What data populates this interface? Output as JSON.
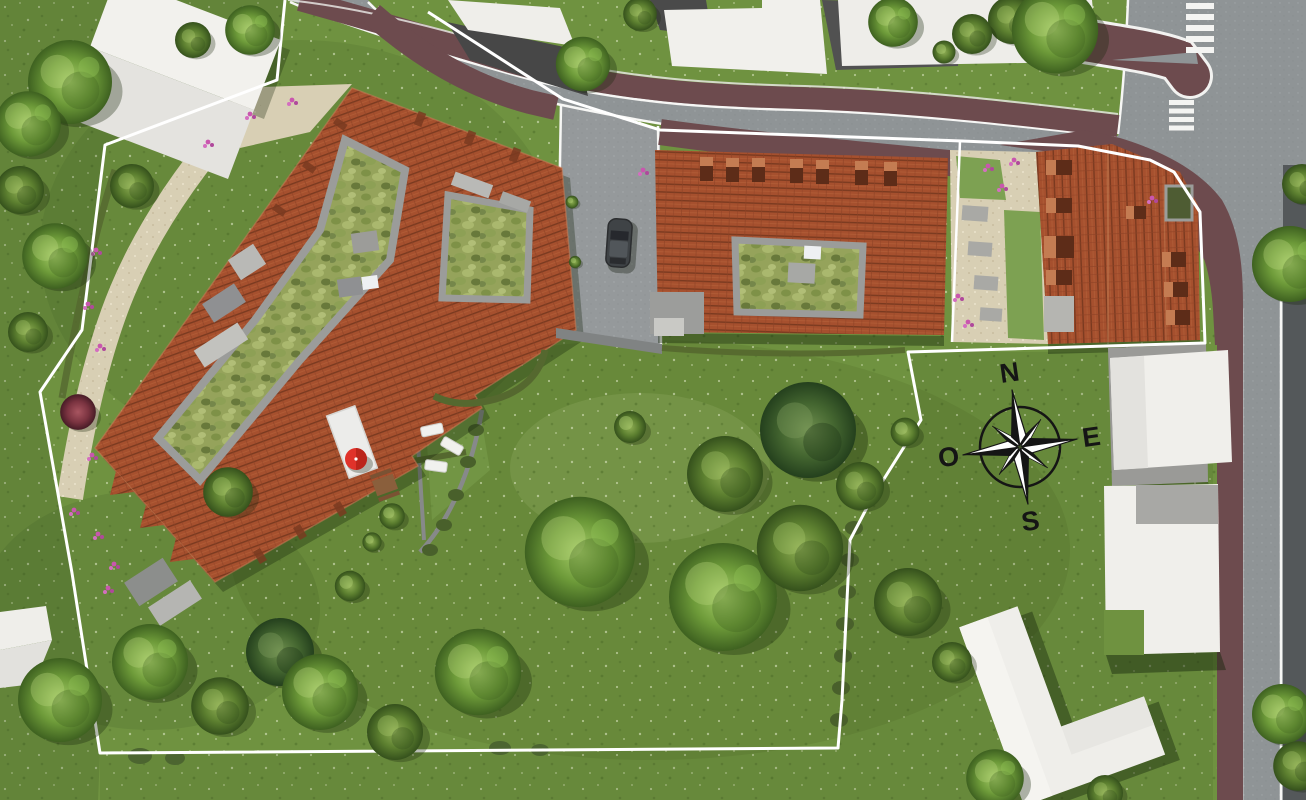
{
  "scene": {
    "type": "aerial-site-plan-rendering",
    "width": 1306,
    "height": 800
  },
  "compass": {
    "north": "N",
    "east": "E",
    "south": "S",
    "west": "O"
  },
  "palette": {
    "grass": "#6f9240",
    "road": "#8f9496",
    "road_dark": "#54585a",
    "sidewalk": "#6d4b4e",
    "roof_tile": "#a6502e",
    "green_roof": "#95a35b",
    "path_gray": "#9b9c9a",
    "concrete": "#c6c6c2",
    "gravel": "#d8cfb4",
    "white_roof": "#f0efeb",
    "boundary": "#ffffff",
    "crosswalk": "#f4f4f2",
    "parasol": "#e0322a",
    "car": "#3f4346",
    "hedge": "#55682f"
  },
  "features": {
    "boundary_line": "property-limit",
    "buildings": [
      "green-roof-residence-west",
      "courtyard-residence-center",
      "residence-east"
    ],
    "landmarks": [
      "compass-rose",
      "red-parasol",
      "parked-car",
      "pedestrian-crossing"
    ]
  }
}
